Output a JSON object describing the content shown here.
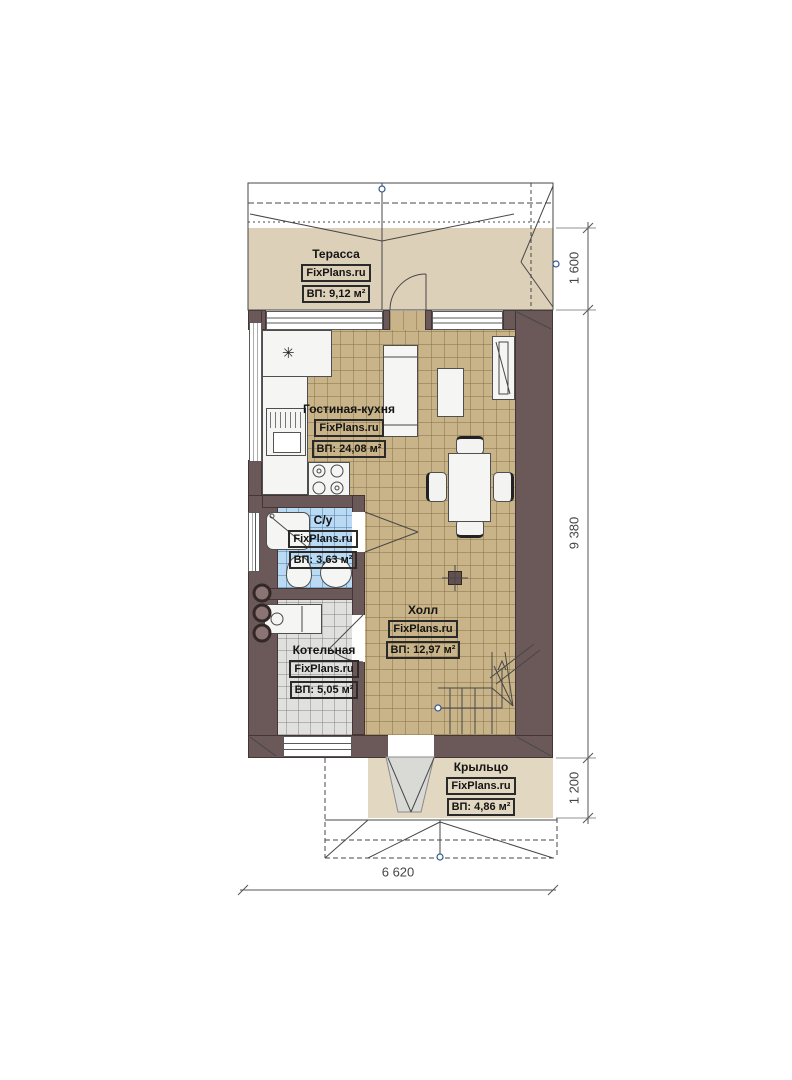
{
  "plan": {
    "brand": "FixPlans.ru",
    "rooms": [
      {
        "name": "Терасса",
        "brand": "FixPlans.ru",
        "area": "ВП: 9,12 м²"
      },
      {
        "name": "Гостиная-кухня",
        "brand": "FixPlans.ru",
        "area": "ВП: 24,08 м²"
      },
      {
        "name": "С/у",
        "brand": "FixPlans.ru",
        "area": "ВП: 3,63 м²"
      },
      {
        "name": "Холл",
        "brand": "FixPlans.ru",
        "area": "ВП: 12,97 м²"
      },
      {
        "name": "Котельная",
        "brand": "FixPlans.ru",
        "area": "ВП: 5,05 м²"
      },
      {
        "name": "Крыльцо",
        "brand": "FixPlans.ru",
        "area": "ВП: 4,86 м²"
      }
    ],
    "dimensions": {
      "terrace_depth": "1 600",
      "house_length": "9 380",
      "porch_depth": "1 200",
      "house_width": "6 620"
    },
    "icons": {
      "extractor": "✳"
    },
    "colors": {
      "wall": "#6b5858",
      "floor_tile": "#c9b489",
      "bath_tile": "#b9daf2",
      "boiler_tile": "#e0e0de",
      "terrace_floor": "#dcd0b9",
      "porch_floor": "#e2d7c1"
    }
  }
}
